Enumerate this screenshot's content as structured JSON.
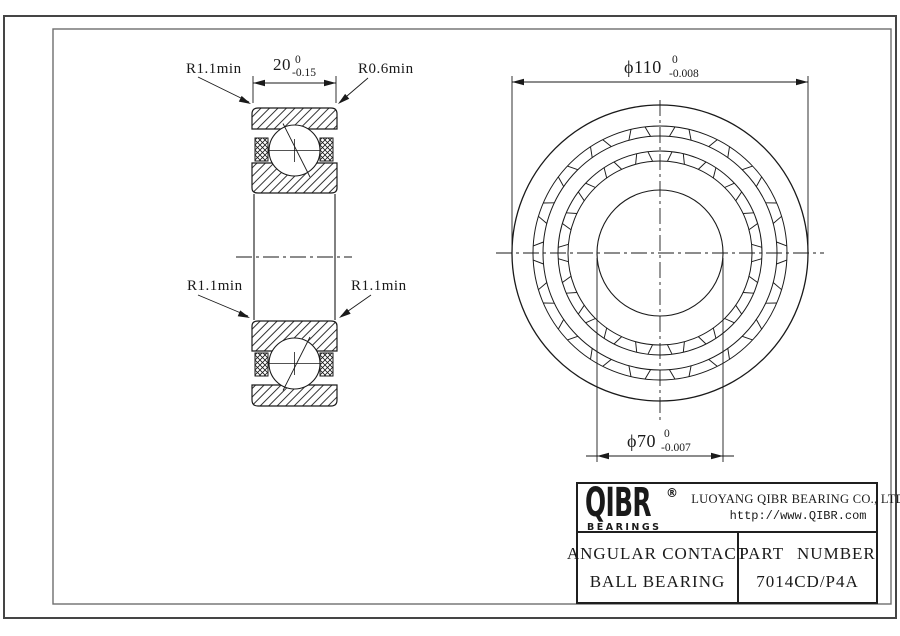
{
  "colors": {
    "line": "#1a1a1a",
    "frame_outer": "#454545",
    "frame_inner": "#6e6e6e",
    "bg": "#ffffff"
  },
  "section_view": {
    "width_dim": {
      "value": "20",
      "upper": "0",
      "lower": "-0.15"
    },
    "fillet_top_left": "R1.1min",
    "fillet_top_right": "R0.6min",
    "fillet_bottom_left": "R1.1min",
    "fillet_bottom_right": "R1.1min"
  },
  "front_view": {
    "od_dim": {
      "value": "ϕ110",
      "upper": "0",
      "lower": "-0.008"
    },
    "bore_dim": {
      "value": "ϕ70",
      "upper": "0",
      "lower": "-0.007"
    }
  },
  "title_block": {
    "logo_text": "QIBR",
    "logo_registered": "®",
    "logo_subtext": "BEARINGS",
    "company_name": "LUOYANG QIBR BEARING CO., LTD",
    "website": "http://www.QIBR.com",
    "product_type_line1": "ANGULAR CONTACT",
    "product_type_line2": "BALL BEARING",
    "part_number_label": "PART NUMBER",
    "part_number": "7014CD/P4A"
  }
}
